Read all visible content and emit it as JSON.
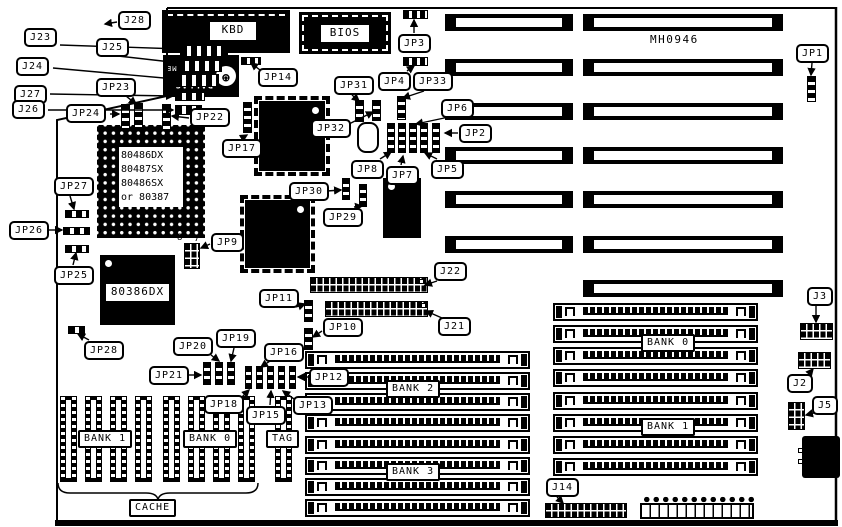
{
  "title": {
    "part_number": "MH0946"
  },
  "cpu_socket_label": {
    "lines": [
      "80486DX",
      "80487SX",
      "80486SX",
      "or 80387"
    ],
    "x": 119,
    "y": 147,
    "w": 64,
    "h": 60
  },
  "dallas": {
    "lines": [
      "DALLAS",
      "DS1287",
      "REAL TIME"
    ],
    "logo": "dallas-bat-logo",
    "x": 163,
    "y": 55,
    "w": 76,
    "h": 42
  },
  "chip_labels": [
    {
      "t": "KBD",
      "x": 210,
      "y": 22,
      "w": 46,
      "h": 18
    },
    {
      "t": "BIOS",
      "x": 321,
      "y": 25,
      "w": 48,
      "h": 17
    },
    {
      "t": "80386DX",
      "x": 106,
      "y": 284,
      "w": 63,
      "h": 17
    }
  ],
  "bank_labels": [
    {
      "t": "BANK 1",
      "x": 78,
      "y": 430
    },
    {
      "t": "BANK 0",
      "x": 183,
      "y": 430
    },
    {
      "t": "TAG",
      "x": 266,
      "y": 430
    },
    {
      "t": "CACHE",
      "x": 129,
      "y": 499
    },
    {
      "t": "BANK 2",
      "x": 386,
      "y": 380
    },
    {
      "t": "BANK 3",
      "x": 386,
      "y": 463
    },
    {
      "t": "BANK 0",
      "x": 641,
      "y": 334
    },
    {
      "t": "BANK 1",
      "x": 641,
      "y": 418
    }
  ],
  "small_texts": [
    {
      "t": "8",
      "x": 177,
      "y": 233
    },
    {
      "t": "7",
      "x": 194,
      "y": 234
    }
  ],
  "callouts": [
    {
      "t": "J28",
      "x": 118,
      "y": 11,
      "lead": [
        117,
        22,
        105,
        24
      ]
    },
    {
      "t": "J23",
      "x": 24,
      "y": 28,
      "lead": [
        60,
        45,
        180,
        49
      ]
    },
    {
      "t": "J25",
      "x": 96,
      "y": 38,
      "lead": [
        118,
        56,
        180,
        63
      ]
    },
    {
      "t": "J24",
      "x": 16,
      "y": 57,
      "lead": [
        53,
        68,
        175,
        79
      ]
    },
    {
      "t": "J27",
      "x": 14,
      "y": 85,
      "lead": [
        50,
        94,
        173,
        96
      ]
    },
    {
      "t": "J26",
      "x": 12,
      "y": 100,
      "lead": [
        48,
        110,
        173,
        110
      ]
    },
    {
      "t": "JP23",
      "x": 96,
      "y": 78,
      "lead": [
        126,
        96,
        136,
        104
      ]
    },
    {
      "t": "JP24",
      "x": 66,
      "y": 104,
      "lead": [
        110,
        114,
        119,
        114
      ]
    },
    {
      "t": "JP22",
      "x": 190,
      "y": 108,
      "lead": [
        189,
        118,
        172,
        116
      ]
    },
    {
      "t": "JP14",
      "x": 258,
      "y": 68,
      "lead": [
        260,
        70,
        251,
        63
      ]
    },
    {
      "t": "JP3",
      "x": 398,
      "y": 34,
      "lead": [
        414,
        33,
        414,
        20
      ]
    },
    {
      "t": "JP4",
      "x": 378,
      "y": 72,
      "lead": [
        407,
        71,
        414,
        66
      ]
    },
    {
      "t": "JP33",
      "x": 413,
      "y": 72,
      "lead": [
        424,
        91,
        403,
        98
      ]
    },
    {
      "t": "JP31",
      "x": 334,
      "y": 76,
      "lead": [
        352,
        95,
        359,
        101
      ]
    },
    {
      "t": "JP32",
      "x": 311,
      "y": 119,
      "lead": [
        349,
        124,
        373,
        112
      ]
    },
    {
      "t": "JP6",
      "x": 441,
      "y": 99,
      "lead": [
        449,
        117,
        416,
        124
      ]
    },
    {
      "t": "JP2",
      "x": 459,
      "y": 124,
      "lead": [
        458,
        133,
        445,
        133
      ]
    },
    {
      "t": "JP5",
      "x": 431,
      "y": 160,
      "lead": [
        437,
        159,
        425,
        153
      ]
    },
    {
      "t": "JP8",
      "x": 351,
      "y": 160,
      "lead": [
        380,
        159,
        391,
        152
      ]
    },
    {
      "t": "JP7",
      "x": 386,
      "y": 166,
      "lead": [
        401,
        165,
        403,
        156
      ]
    },
    {
      "t": "JP17",
      "x": 222,
      "y": 139,
      "lead": [
        242,
        138,
        247,
        135
      ]
    },
    {
      "t": "JP30",
      "x": 289,
      "y": 182,
      "lead": [
        327,
        191,
        341,
        190
      ]
    },
    {
      "t": "JP29",
      "x": 323,
      "y": 208,
      "lead": [
        354,
        207,
        362,
        206
      ]
    },
    {
      "t": "JP9",
      "x": 211,
      "y": 233,
      "lead": [
        210,
        244,
        201,
        248
      ]
    },
    {
      "t": "JP27",
      "x": 54,
      "y": 177,
      "lead": [
        70,
        196,
        74,
        209
      ]
    },
    {
      "t": "JP26",
      "x": 9,
      "y": 221,
      "lead": [
        47,
        230,
        62,
        230
      ]
    },
    {
      "t": "JP25",
      "x": 54,
      "y": 266,
      "lead": [
        73,
        265,
        76,
        253
      ]
    },
    {
      "t": "JP28",
      "x": 84,
      "y": 341,
      "lead": [
        89,
        340,
        78,
        334
      ]
    },
    {
      "t": "J22",
      "x": 434,
      "y": 262,
      "lead": [
        437,
        281,
        425,
        285
      ]
    },
    {
      "t": "J21",
      "x": 438,
      "y": 317,
      "lead": [
        442,
        318,
        426,
        311
      ]
    },
    {
      "t": "JP11",
      "x": 259,
      "y": 289,
      "lead": [
        296,
        307,
        305,
        304
      ]
    },
    {
      "t": "JP10",
      "x": 323,
      "y": 318,
      "lead": [
        322,
        331,
        313,
        337
      ]
    },
    {
      "t": "JP16",
      "x": 264,
      "y": 343,
      "lead": [
        270,
        361,
        261,
        367
      ]
    },
    {
      "t": "JP20",
      "x": 173,
      "y": 337,
      "lead": [
        211,
        355,
        219,
        361
      ]
    },
    {
      "t": "JP19",
      "x": 216,
      "y": 329,
      "lead": [
        234,
        348,
        231,
        361
      ]
    },
    {
      "t": "JP21",
      "x": 149,
      "y": 366,
      "lead": [
        187,
        375,
        201,
        375
      ]
    },
    {
      "t": "JP12",
      "x": 309,
      "y": 368,
      "lead": [
        308,
        377,
        298,
        377
      ]
    },
    {
      "t": "JP18",
      "x": 204,
      "y": 395,
      "lead": [
        242,
        397,
        249,
        390
      ]
    },
    {
      "t": "JP15",
      "x": 246,
      "y": 406,
      "lead": [
        270,
        405,
        271,
        391
      ]
    },
    {
      "t": "JP13",
      "x": 293,
      "y": 396,
      "lead": [
        294,
        399,
        283,
        391
      ]
    },
    {
      "t": "JP1",
      "x": 796,
      "y": 44,
      "lead": [
        812,
        63,
        811,
        75
      ]
    },
    {
      "t": "J3",
      "x": 807,
      "y": 287,
      "lead": [
        816,
        306,
        816,
        322
      ]
    },
    {
      "t": "J2",
      "x": 787,
      "y": 374,
      "lead": [
        808,
        375,
        813,
        369
      ]
    },
    {
      "t": "J5",
      "x": 812,
      "y": 396,
      "lead": [
        814,
        413,
        806,
        415
      ]
    },
    {
      "t": "J14",
      "x": 546,
      "y": 478,
      "lead": [
        557,
        497,
        563,
        503
      ]
    }
  ],
  "jumpers_v": [
    [
      121,
      104,
      9,
      25
    ],
    [
      134,
      103,
      9,
      25
    ],
    [
      162,
      104,
      9,
      26
    ],
    [
      243,
      102,
      9,
      31
    ],
    [
      355,
      100,
      9,
      22
    ],
    [
      372,
      100,
      9,
      21
    ],
    [
      397,
      96,
      9,
      24
    ],
    [
      342,
      178,
      8,
      22
    ],
    [
      359,
      184,
      8,
      23
    ],
    [
      304,
      300,
      9,
      22
    ],
    [
      304,
      328,
      9,
      22
    ],
    [
      807,
      76,
      9,
      26
    ],
    [
      203,
      362,
      8,
      23
    ],
    [
      215,
      362,
      8,
      23
    ],
    [
      227,
      362,
      8,
      23
    ],
    [
      245,
      366,
      7,
      23
    ],
    [
      256,
      366,
      7,
      23
    ],
    [
      267,
      366,
      7,
      23
    ],
    [
      278,
      366,
      7,
      23
    ],
    [
      289,
      366,
      7,
      23
    ],
    [
      387,
      123,
      8,
      30
    ],
    [
      398,
      123,
      8,
      30
    ],
    [
      409,
      123,
      8,
      30
    ],
    [
      420,
      123,
      8,
      30
    ],
    [
      432,
      123,
      8,
      30
    ]
  ],
  "jumpers_h": [
    [
      403,
      10,
      25,
      9
    ],
    [
      403,
      57,
      25,
      9
    ],
    [
      241,
      57,
      20,
      8
    ]
  ],
  "edge_connectors": [
    [
      180,
      45,
      48,
      12
    ],
    [
      178,
      60,
      44,
      12
    ],
    [
      175,
      74,
      44,
      13
    ],
    [
      175,
      92,
      30,
      9
    ],
    [
      175,
      105,
      27,
      10
    ],
    [
      65,
      210,
      24,
      8
    ],
    [
      63,
      227,
      27,
      8
    ],
    [
      65,
      245,
      24,
      8
    ],
    [
      68,
      326,
      17,
      8
    ]
  ],
  "grid_connectors": [
    [
      310,
      277,
      118,
      16
    ],
    [
      325,
      301,
      103,
      16
    ],
    [
      800,
      323,
      33,
      17
    ],
    [
      798,
      352,
      33,
      17
    ],
    [
      788,
      402,
      17,
      28
    ],
    [
      184,
      243,
      16,
      26
    ],
    [
      545,
      503,
      82,
      15
    ]
  ],
  "white_pins": [
    [
      419,
      279
    ],
    [
      421,
      303
    ]
  ],
  "isa_rows": [
    {
      "y": 14,
      "left": true
    },
    {
      "y": 59,
      "left": true
    },
    {
      "y": 103,
      "left": true
    },
    {
      "y": 147,
      "left": true
    },
    {
      "y": 191,
      "left": true
    },
    {
      "y": 236,
      "left": true
    },
    {
      "y": 280,
      "left": false
    }
  ],
  "isa_geom": {
    "left_x": 445,
    "left_w": 128,
    "right_x": 583,
    "right_w": 200,
    "h": 17
  },
  "simm_groups": [
    {
      "x": 305,
      "w": 225,
      "ys": [
        351,
        372,
        393,
        414,
        436,
        457,
        478,
        499
      ]
    },
    {
      "x": 553,
      "w": 205,
      "ys": [
        303,
        325,
        347,
        369,
        392,
        414,
        436,
        458
      ]
    }
  ],
  "dip_sockets": [
    60,
    85,
    110,
    135,
    163,
    188,
    213,
    238,
    275
  ],
  "chips": [
    {
      "kind": "kbd-chip",
      "name": "keyboard-controller-chip",
      "x": 162,
      "y": 10,
      "w": 128,
      "h": 43
    },
    {
      "kind": "bios-chip",
      "name": "bios-chip",
      "x": 299,
      "y": 12,
      "w": 92,
      "h": 42
    },
    {
      "kind": "qfp",
      "name": "chipset-chip-1",
      "x": 259,
      "y": 101,
      "w": 66,
      "h": 70,
      "dot": "tr"
    },
    {
      "kind": "qfp",
      "name": "chipset-chip-2",
      "x": 245,
      "y": 200,
      "w": 65,
      "h": 68,
      "dot": "tr"
    },
    {
      "kind": "",
      "name": "chip-near-jp7",
      "x": 383,
      "y": 178,
      "w": 38,
      "h": 60,
      "dot": "tl"
    },
    {
      "kind": "",
      "name": "80386dx-cpu-chip",
      "x": 100,
      "y": 255,
      "w": 75,
      "h": 70,
      "dot": "tl"
    }
  ],
  "socket_486": {
    "x": 97,
    "y": 125,
    "w": 108,
    "h": 113
  },
  "crystal": [
    357,
    122,
    22,
    31
  ],
  "power_connector": {
    "x": 640,
    "y": 494,
    "w": 114
  },
  "din_connector": {
    "x": 802,
    "y": 436,
    "w": 38,
    "h": 42
  }
}
